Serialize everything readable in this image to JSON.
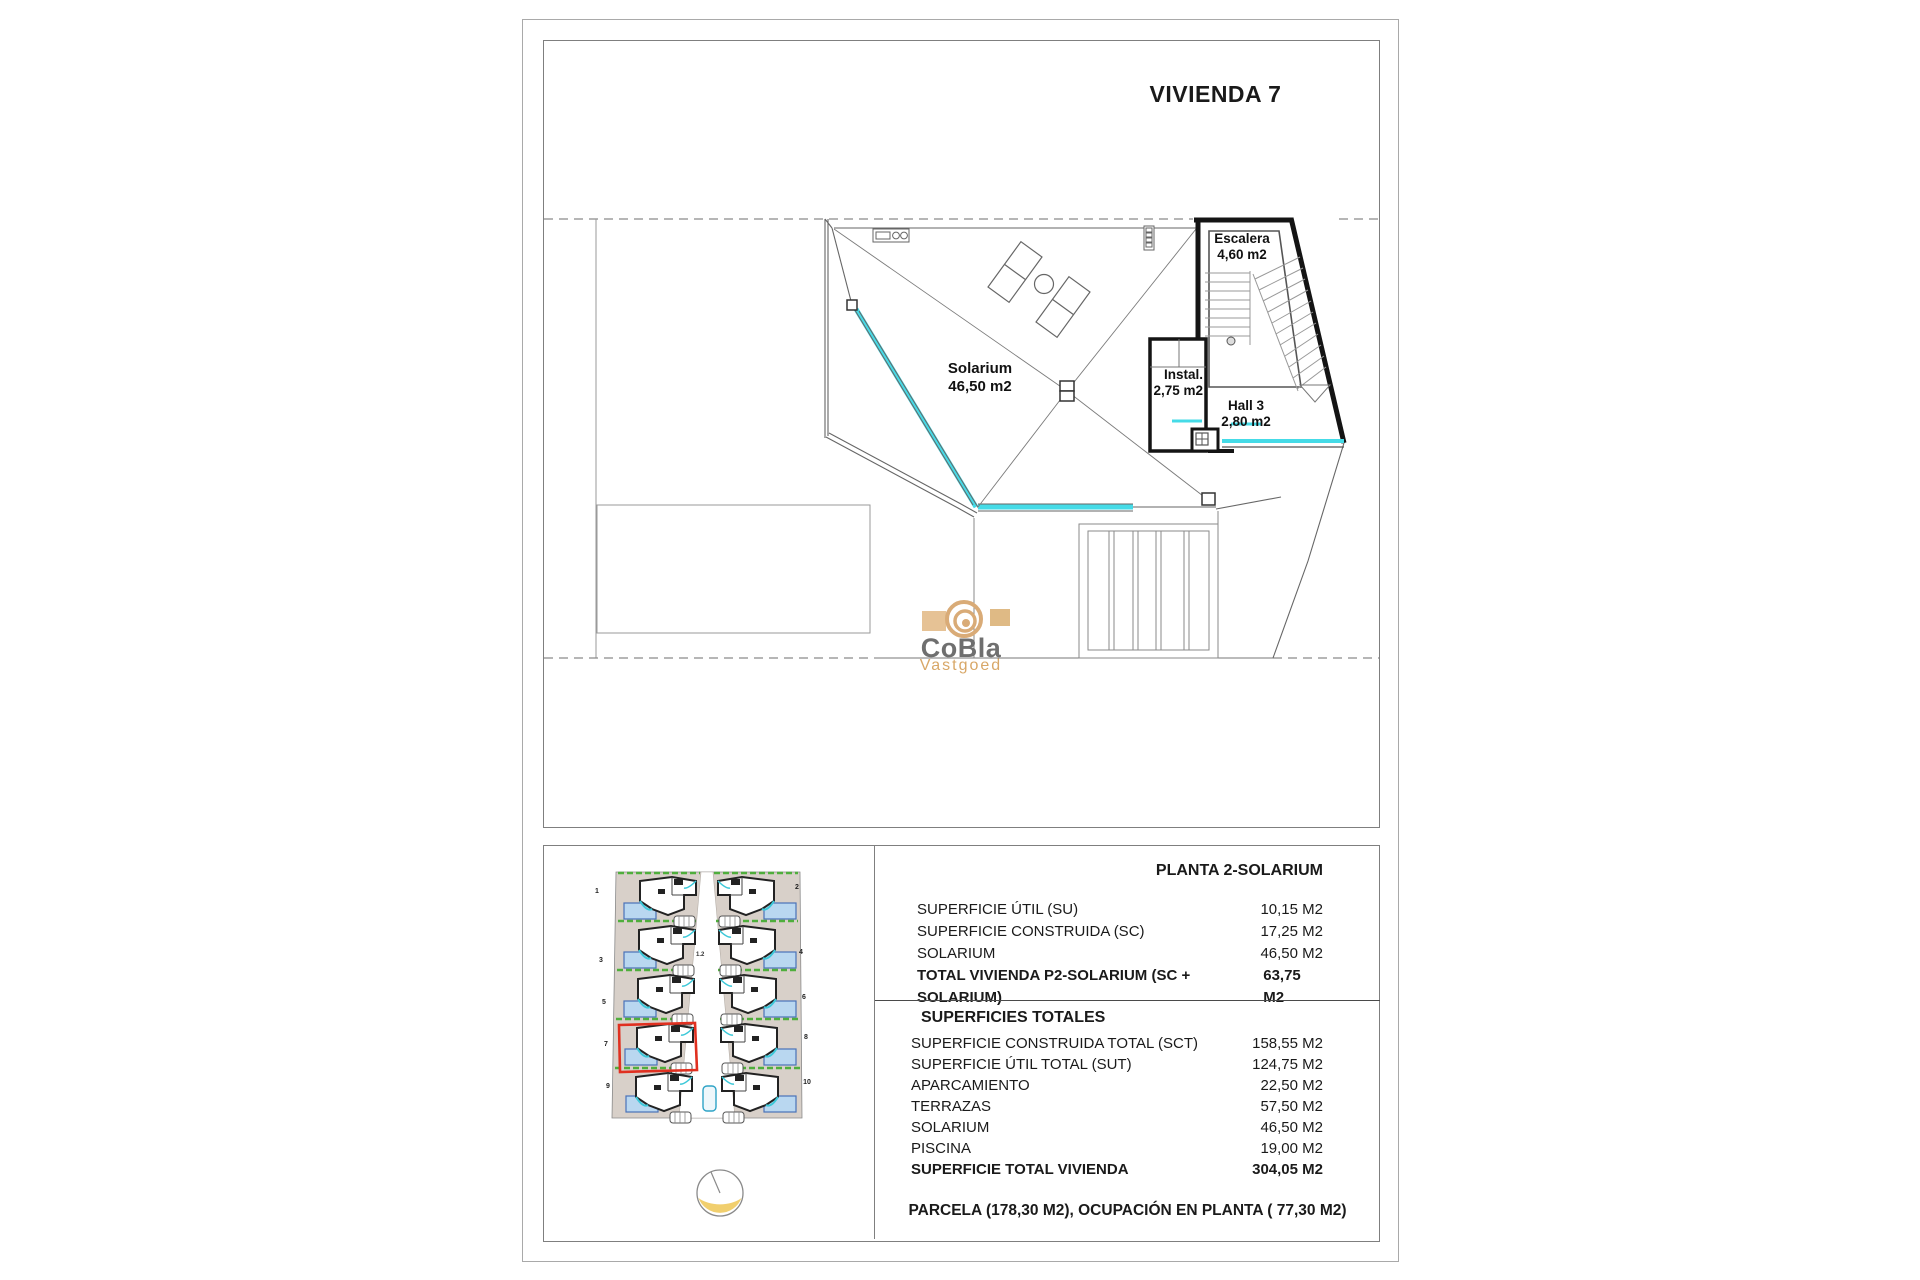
{
  "title": "VIVIENDA 7",
  "plan": {
    "solarium": {
      "name": "Solarium",
      "area": "46,50 m2"
    },
    "escalera": {
      "name": "Escalera",
      "area": "4,60 m2"
    },
    "instal": {
      "name": "Instal.",
      "area": "2,75 m2"
    },
    "hall": {
      "name": "Hall 3",
      "area": "2,80 m2"
    }
  },
  "logo": {
    "name": "CoBla",
    "sub": "Vastgoed"
  },
  "site_plan": {
    "highlighted_unit": "7",
    "units": [
      "1",
      "2",
      "3",
      "4",
      "5",
      "6",
      "7",
      "8",
      "9",
      "10"
    ],
    "road_label": "1.2"
  },
  "table": {
    "planta": {
      "title": "PLANTA 2-SOLARIUM",
      "rows": [
        {
          "label": "SUPERFICIE ÚTIL (SU)",
          "value": "10,15 M2"
        },
        {
          "label": "SUPERFICIE CONSTRUIDA (SC)",
          "value": "17,25 M2"
        },
        {
          "label": "SOLARIUM",
          "value": "46,50 M2"
        },
        {
          "label": "TOTAL VIVIENDA P2-SOLARIUM (SC + SOLARIUM)",
          "value": "63,75 M2"
        }
      ]
    },
    "totales": {
      "title": "SUPERFICIES TOTALES",
      "rows": [
        {
          "label": "SUPERFICIE CONSTRUIDA TOTAL (SCT)",
          "value": "158,55 M2"
        },
        {
          "label": "SUPERFICIE ÚTIL TOTAL (SUT)",
          "value": "124,75 M2"
        },
        {
          "label": "APARCAMIENTO",
          "value": "22,50 M2"
        },
        {
          "label": "TERRAZAS",
          "value": "57,50 M2"
        },
        {
          "label": "SOLARIUM",
          "value": "46,50 M2"
        },
        {
          "label": "PISCINA",
          "value": "19,00 M2"
        },
        {
          "label": "SUPERFICIE TOTAL VIVIENDA",
          "value": "304,05 M2"
        }
      ]
    },
    "parcela_line": "PARCELA  (178,30 M2), OCUPACIÓN EN PLANTA ( 77,30 M2)"
  },
  "colors": {
    "cyan_accent": "#45dbe7",
    "highlight_red": "#e03020",
    "logo_tan": "#d8a767",
    "logo_gray": "#6f6f6f",
    "compass_yellow": "#f1cf6e",
    "pool_blue": "#b9d7f0",
    "green_strip": "#4fae3c",
    "plot_beige": "#d8d0c9"
  }
}
